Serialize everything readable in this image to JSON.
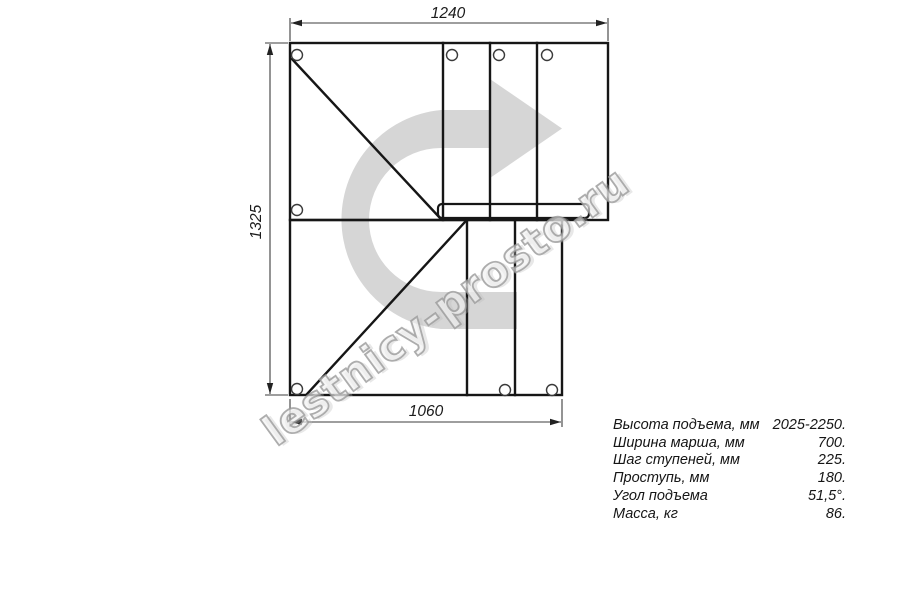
{
  "title": "Staircase plan drawing with U-turn",
  "watermark": {
    "text": "lestnicy-prosto.ru"
  },
  "dimensions": {
    "top_width_mm": "1240",
    "left_height_mm": "1325",
    "bottom_width_mm": "1060"
  },
  "specs": {
    "rows": [
      {
        "label": "Высота подъема, мм",
        "value": "2025-2250."
      },
      {
        "label": "Ширина марша, мм",
        "value": "700."
      },
      {
        "label": "Шаг ступеней, мм",
        "value": "225."
      },
      {
        "label": "Проступь, мм",
        "value": "180."
      },
      {
        "label": "Угол подъема",
        "value": "51,5°."
      },
      {
        "label": "Масса, кг",
        "value": "86."
      }
    ]
  },
  "colors": {
    "arrow_fill": "#d6d6d6",
    "line_color": "#161616",
    "dim_color": "#3c3c3c",
    "background": "#ffffff"
  }
}
